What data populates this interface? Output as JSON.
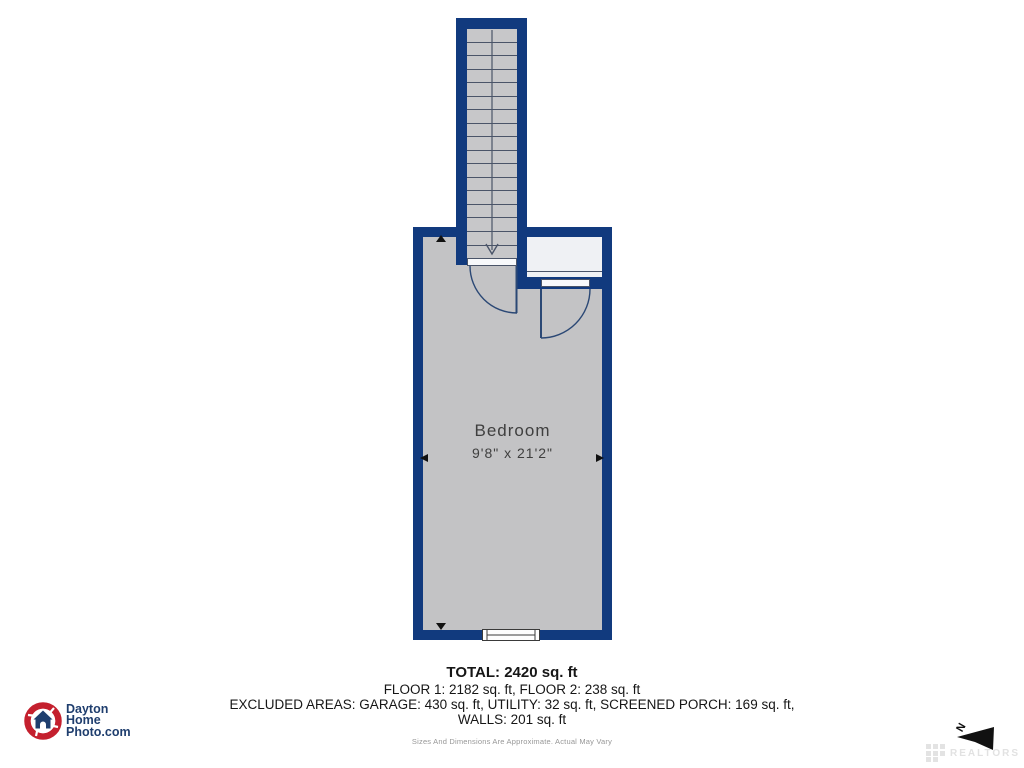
{
  "plan": {
    "room": {
      "label": "Bedroom",
      "dimensions": "9'8\" x 21'2\""
    },
    "stairs": {
      "treads": 16,
      "direction": "down"
    }
  },
  "summary": {
    "total": "TOTAL: 2420 sq. ft",
    "floors": "FLOOR 1: 2182 sq. ft, FLOOR 2: 238 sq. ft",
    "excluded": "EXCLUDED AREAS: GARAGE: 430 sq. ft, UTILITY: 32 sq. ft, SCREENED PORCH: 169 sq. ft,",
    "walls": "WALLS: 201 sq. ft",
    "disclaimer": "Sizes And Dimensions Are Approximate. Actual May Vary"
  },
  "logo": {
    "line1": "Dayton",
    "line2": "Home",
    "line3": "Photo.com"
  },
  "compass": {
    "north_label": "N"
  },
  "watermark": {
    "text": "REALTORS"
  },
  "colors": {
    "wall_blue": "#113a7e",
    "room_fill": "#c3c3c5",
    "alcove_fill": "#eff1f4",
    "line_dark": "#4a5468",
    "logo_navy": "#1f3e6e",
    "logo_red": "#c4202e"
  }
}
